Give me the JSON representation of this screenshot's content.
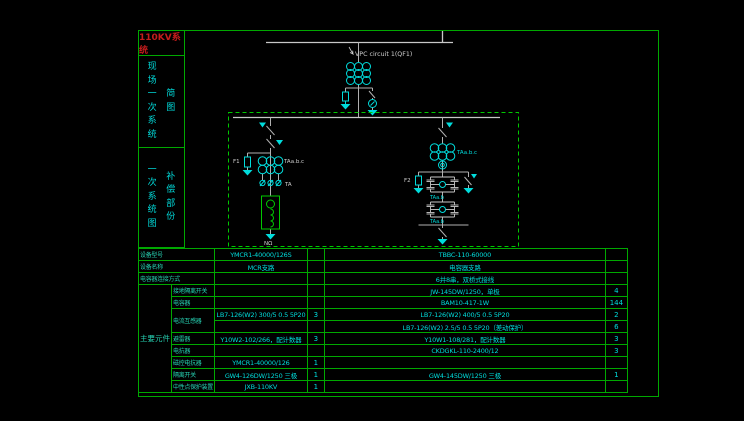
{
  "colors": {
    "border_green": "#00a800",
    "dashed_green": "#00c800",
    "cyan": "#00dcdc",
    "label_teal": "#27d3b4",
    "title_red": "#c41c1c",
    "line_gray": "#c8c8c8"
  },
  "sidebar": {
    "system_title": "110KV系统",
    "block1": {
      "col1": "现场一次系统",
      "col2": "简图"
    },
    "block2": {
      "col1": "一次系统图",
      "col2": "补偿部份"
    }
  },
  "diagram": {
    "feeder_label": "VPC circuit 1(QF1)",
    "left": {
      "arrester": "F1",
      "ct": "TAa.b.c",
      "ta": "TA",
      "ground": "NΩ"
    },
    "right": {
      "arrester": "F2",
      "ct": "TAa.b.c",
      "bridge1": "TAa.b",
      "bridge2": "TAa.b"
    }
  },
  "table": {
    "group": "主要元件",
    "rows": [
      {
        "label": "设备型号",
        "mcr": "YMCR1-40000/126S",
        "mq": "",
        "cap": "TBBC-110-60000",
        "cq": ""
      },
      {
        "label": "设备名称",
        "mcr": "MCR支路",
        "mq": "",
        "cap": "电容器支路",
        "cq": ""
      },
      {
        "label": "电容器连接方式",
        "mcr": "",
        "mq": "",
        "cap": "6并8串，双桥式接线",
        "cq": ""
      },
      {
        "label": "接地隔离开关",
        "mcr": "",
        "mq": "",
        "cap": "JW-145DW/1250，单极",
        "cq": "4"
      },
      {
        "label": "电容器",
        "mcr": "",
        "mq": "",
        "cap": "BAM10-417-1W",
        "cq": "144"
      },
      {
        "label": "电流互感器",
        "mcr": "LB7-126(W2) 300/5 0.5 5P20",
        "mq": "3",
        "cap": "LB7-126(W2) 400/5 0.5 5P20",
        "cq": "2"
      },
      {
        "label": "",
        "mcr": "",
        "mq": "",
        "cap": "LB7-126(W2) 2.5/5 0.5 5P20（差动保护）",
        "cq": "6"
      },
      {
        "label": "避雷器",
        "mcr": "Y10W2-102/266，配计数器",
        "mq": "3",
        "cap": "Y10W1-108/281，配计数器",
        "cq": "3"
      },
      {
        "label": "电抗器",
        "mcr": "",
        "mq": "",
        "cap": "CKDGKL-110-2400/12",
        "cq": "3"
      },
      {
        "label": "磁控电抗器",
        "mcr": "YMCR1-40000/126",
        "mq": "1",
        "cap": "",
        "cq": ""
      },
      {
        "label": "隔离开关",
        "mcr": "GW4-126DW/1250 三极",
        "mq": "1",
        "cap": "GW4-145DW/1250 三极",
        "cq": "1"
      },
      {
        "label": "中性点保护装置",
        "mcr": "JXB-110KV",
        "mq": "1",
        "cap": "",
        "cq": ""
      }
    ]
  }
}
